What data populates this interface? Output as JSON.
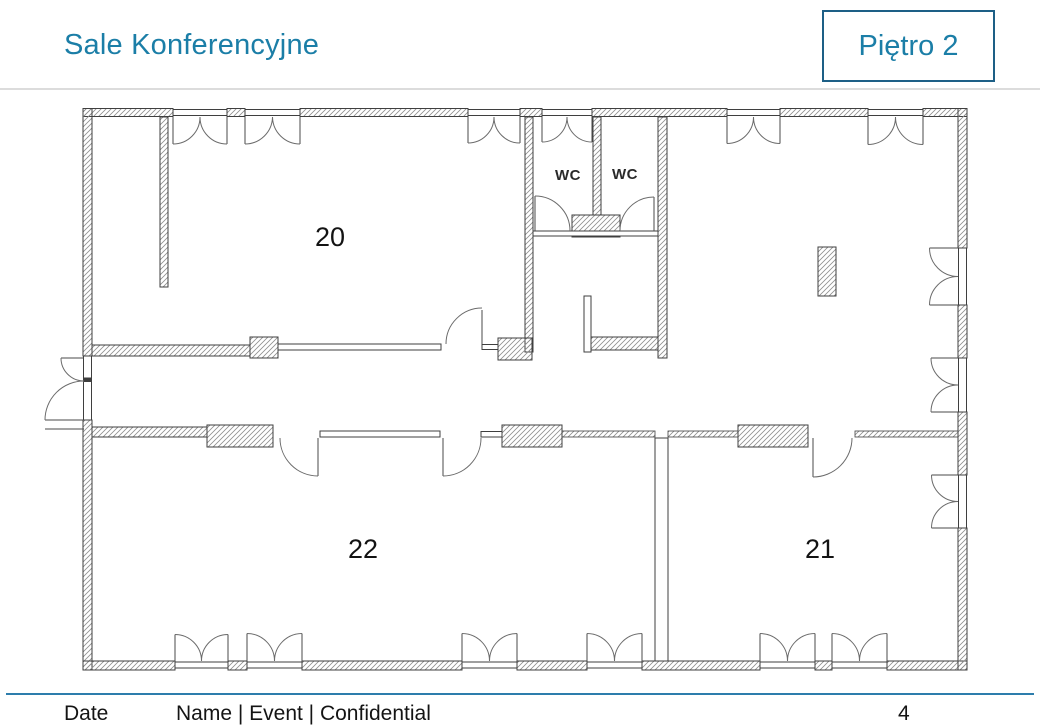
{
  "header": {
    "title": "Sale Konferencyjne",
    "floor_badge": "Piętro 2"
  },
  "floor_plan": {
    "rooms": [
      {
        "id": "room-20",
        "label": "20"
      },
      {
        "id": "room-22",
        "label": "22"
      },
      {
        "id": "room-21",
        "label": "21"
      }
    ],
    "wc_labels": [
      "WC",
      "WC"
    ]
  },
  "footer": {
    "date_label": "Date",
    "info": "Name | Event | Confidential",
    "page_number": "4"
  },
  "colors": {
    "accent_teal": "#1b7ea7",
    "badge_border": "#1d5f86",
    "footer_line": "#2d7dac",
    "plan_line": "#3f3f3f",
    "hatch_gray": "#8f8f8f"
  }
}
